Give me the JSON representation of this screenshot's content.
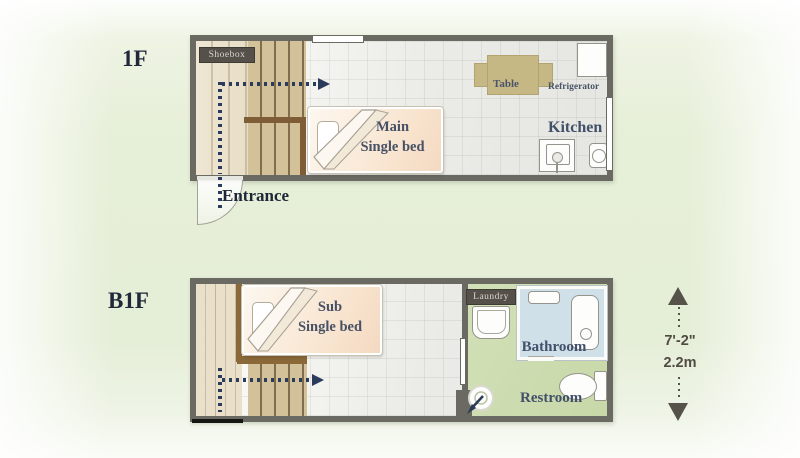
{
  "floor_1f": {
    "label": "1F",
    "shoebox_label": "Shoebox",
    "bed_name_line1": "Main",
    "bed_name_line2": "Single bed",
    "table_label": "Table",
    "refrigerator_label": "Refrigerator",
    "kitchen_label": "Kitchen",
    "entrance_label": "Entrance"
  },
  "floor_b1f": {
    "label": "B1F",
    "bed_name_line1": "Sub",
    "bed_name_line2": "Single bed",
    "laundry_label": "Laundry",
    "bathroom_label": "Bathroom",
    "restroom_label": "Restroom"
  },
  "dimension": {
    "feet_inches": "7'-2\"",
    "meters": "2.2m"
  },
  "colors": {
    "wall": "#6a6a62",
    "route_navy": "#2a3b5c",
    "wood_plank": "#d3c19a",
    "green_floor": "#ccdbae",
    "bathroom_floor": "#cfe0e9",
    "bed_fill": "#f8e3cd",
    "table_tan": "#c6b884"
  }
}
